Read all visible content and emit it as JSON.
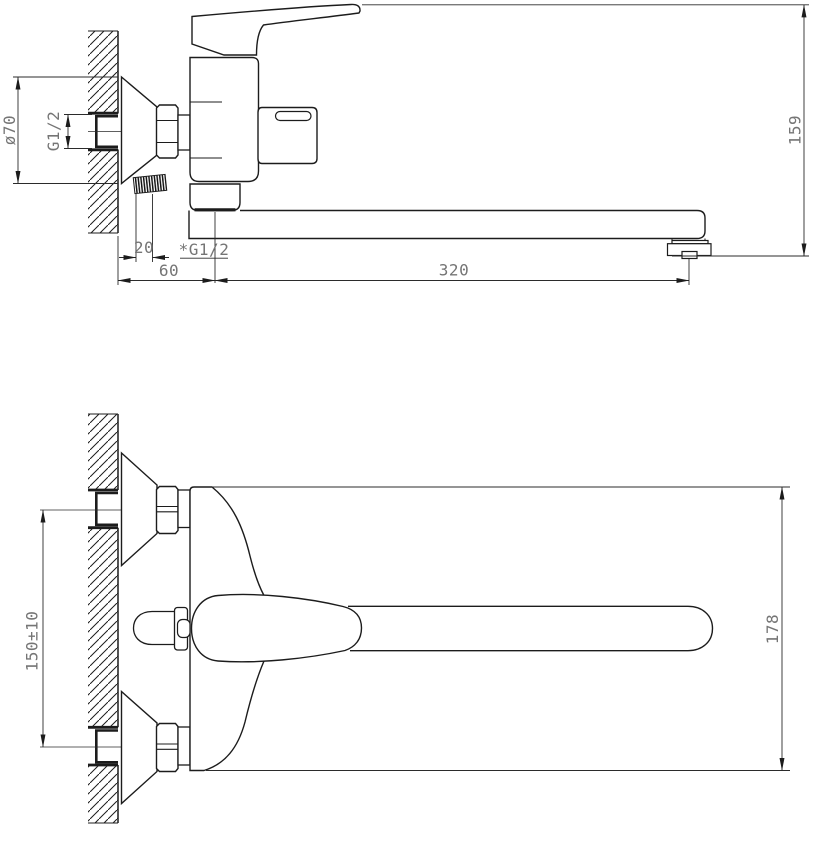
{
  "drawing": {
    "kind": "faucet-technical-drawing",
    "colors": {
      "line": "#1c1c1c",
      "dim_line": "#2b2b2b",
      "dim_text": "#757575",
      "background": "#ffffff"
    },
    "side_view": {
      "dims": {
        "escutcheon_diameter": "ø70",
        "wall_thread": "G1/2",
        "thread_depth": "20",
        "wall_offset": "60",
        "outlet_thread": "*G1/2",
        "spout_reach": "320",
        "overall_height": "159"
      }
    },
    "plan_view": {
      "dims": {
        "connection_centers": "150±10",
        "body_span": "178"
      }
    }
  }
}
